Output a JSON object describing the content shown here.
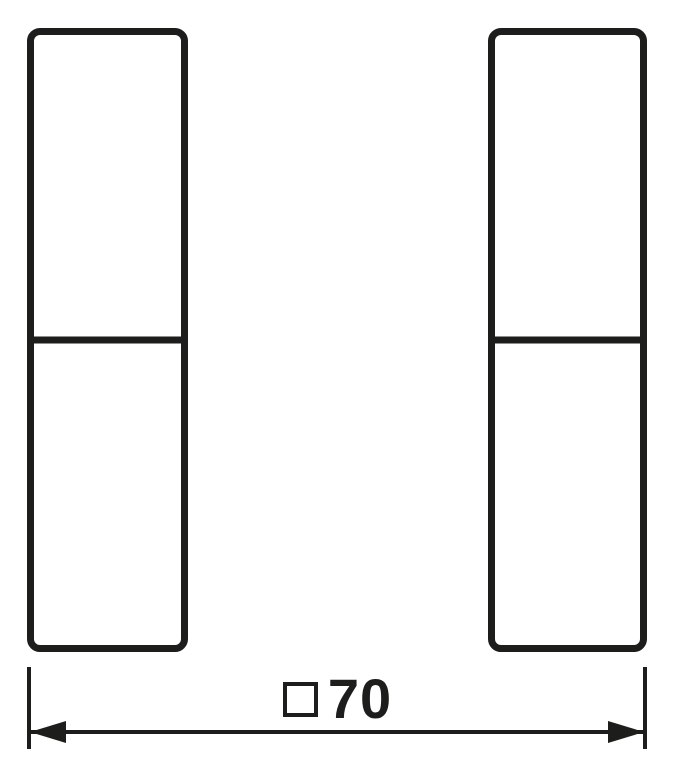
{
  "drawing": {
    "line_color": "#1d1d1b",
    "background_color": "#ffffff",
    "rockers": [
      {
        "name": "left-rocker",
        "segments": 2
      },
      {
        "name": "right-rocker",
        "segments": 2
      }
    ],
    "dimension": {
      "symbol": "□",
      "value": "70",
      "label": "□70"
    }
  }
}
